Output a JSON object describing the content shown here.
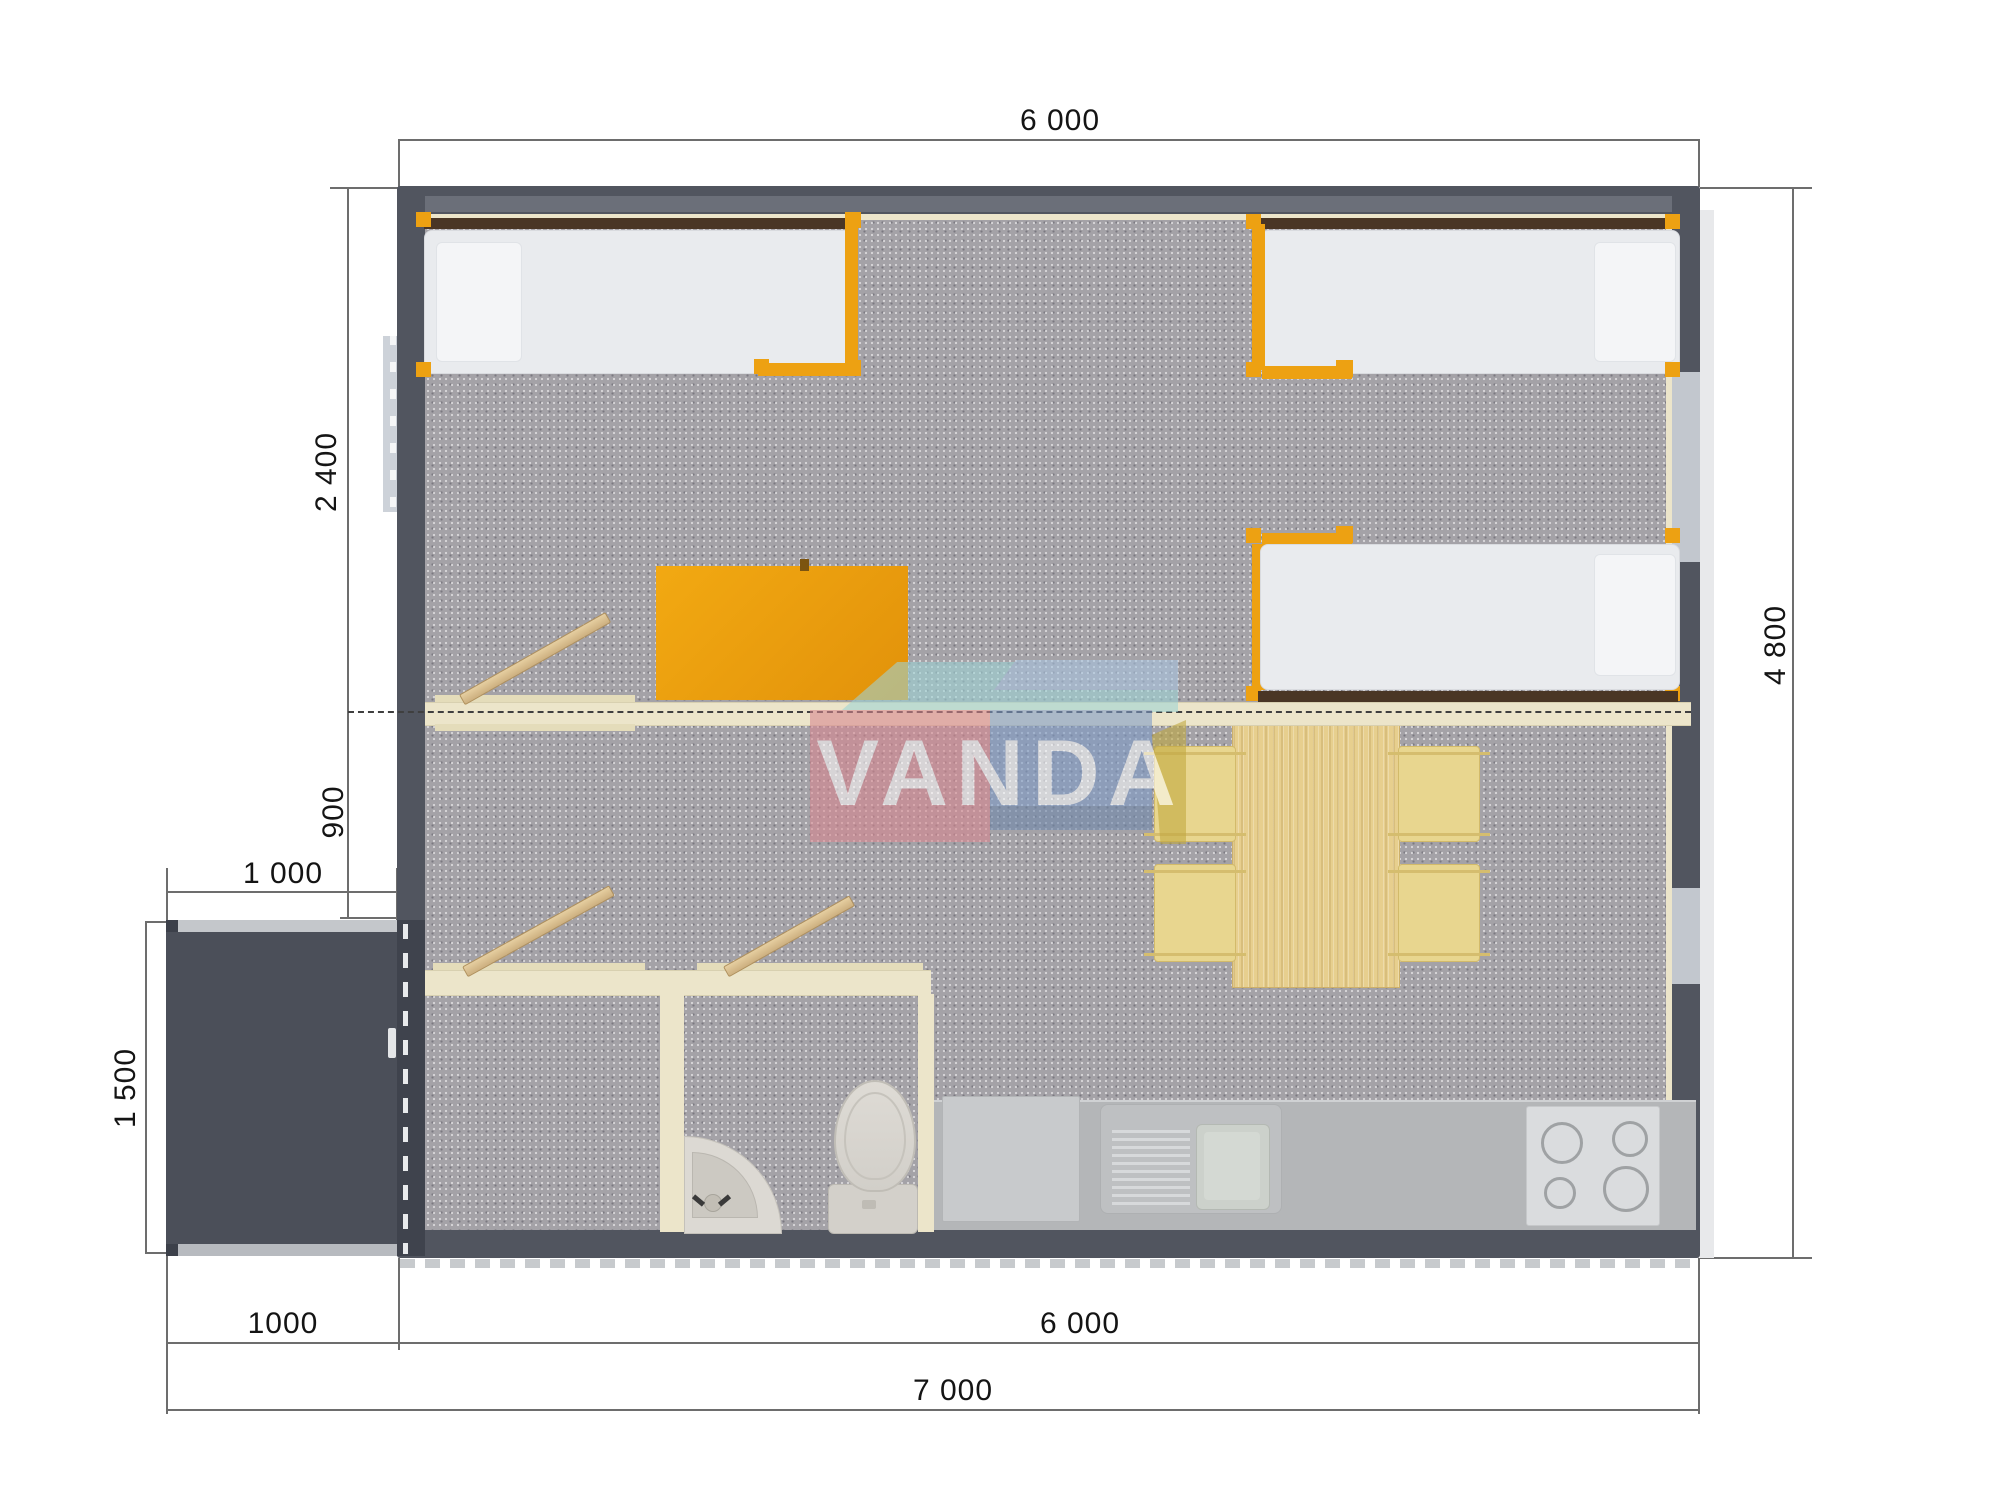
{
  "plan": {
    "watermark_text": "VANDA",
    "dimensions": {
      "top_width": "6 000",
      "bedroom_depth": "2 400",
      "hall_depth": "900",
      "porch_width": "1 000",
      "porch_depth": "1 500",
      "building_depth": "4 800",
      "porch_width_bottom": "1000",
      "building_width": "6 000",
      "total_width": "7 000"
    },
    "colors": {
      "exterior_wall": "#51555f",
      "floor_carpet": "#a4a2a7",
      "interior_wall": "#ece5ca",
      "accent_orange": "#eda112",
      "bed_mattress": "#e9ebee",
      "headboard_wood": "#4a3625",
      "table_wood": "#e7cf8e",
      "chair": "#e8d68f",
      "kitchen_counter": "#b4b6b8",
      "porch_floor": "#4b4f59",
      "watermark_pink": "#d9868f",
      "watermark_blue": "#7e9bc7",
      "watermark_teal": "#9ed4d6",
      "dimension_line": "#6d6d6d"
    }
  }
}
